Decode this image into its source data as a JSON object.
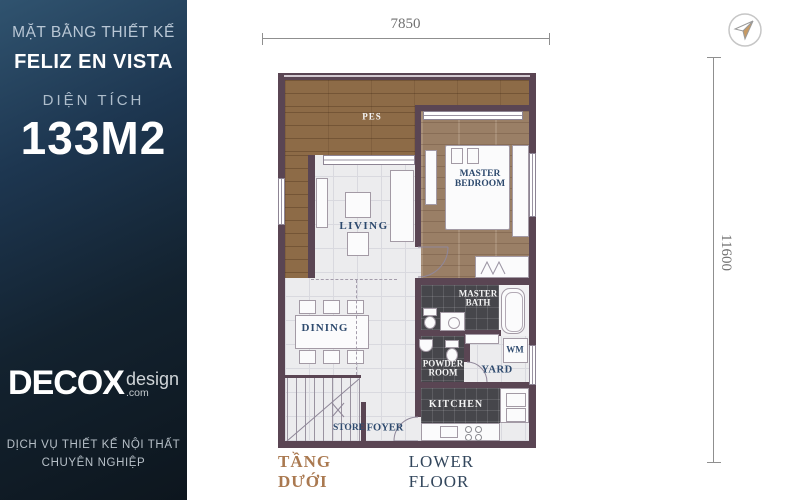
{
  "colors": {
    "sidebar_top": "#30536f",
    "sidebar_bottom": "#0d161e",
    "wall": "#5a4553",
    "wood_balcony": "#8d6b47",
    "wood_bedroom": "#9a7f66",
    "tile_dark": "#46464b",
    "label_navy": "#2e4a6e",
    "caption_accent": "#aa7950",
    "caption_navy": "#32465c",
    "dimension_gray": "#707070",
    "compass_fill": "#c89a62"
  },
  "sidebar": {
    "subtitle": "MẶT BẰNG THIẾT KẾ",
    "project": "FELIZ EN VISTA",
    "area_label": "DIỆN TÍCH",
    "area_value": "133M2",
    "logo_name": "DECOX",
    "logo_suffix": "design",
    "logo_domain": ".com",
    "services_line1": "DỊCH VỤ THIẾT KẾ NỘI THẤT",
    "services_line2": "CHUYÊN NGHIỆP"
  },
  "dimensions": {
    "width": "7850",
    "height": "11600"
  },
  "rooms": {
    "pes": "PES",
    "master_bedroom_1": "MASTER",
    "master_bedroom_2": "BEDROOM",
    "living": "LIVING",
    "dining": "DINING",
    "master_bath_1": "MASTER",
    "master_bath_2": "BATH",
    "powder_1": "POWDER",
    "powder_2": "ROOM",
    "wm": "WM",
    "yard": "YARD",
    "kitchen": "KITCHEN",
    "store": "STORE",
    "foyer": "FOYER"
  },
  "caption": {
    "vi": "TẦNG DƯỚI",
    "en": "LOWER FLOOR"
  }
}
